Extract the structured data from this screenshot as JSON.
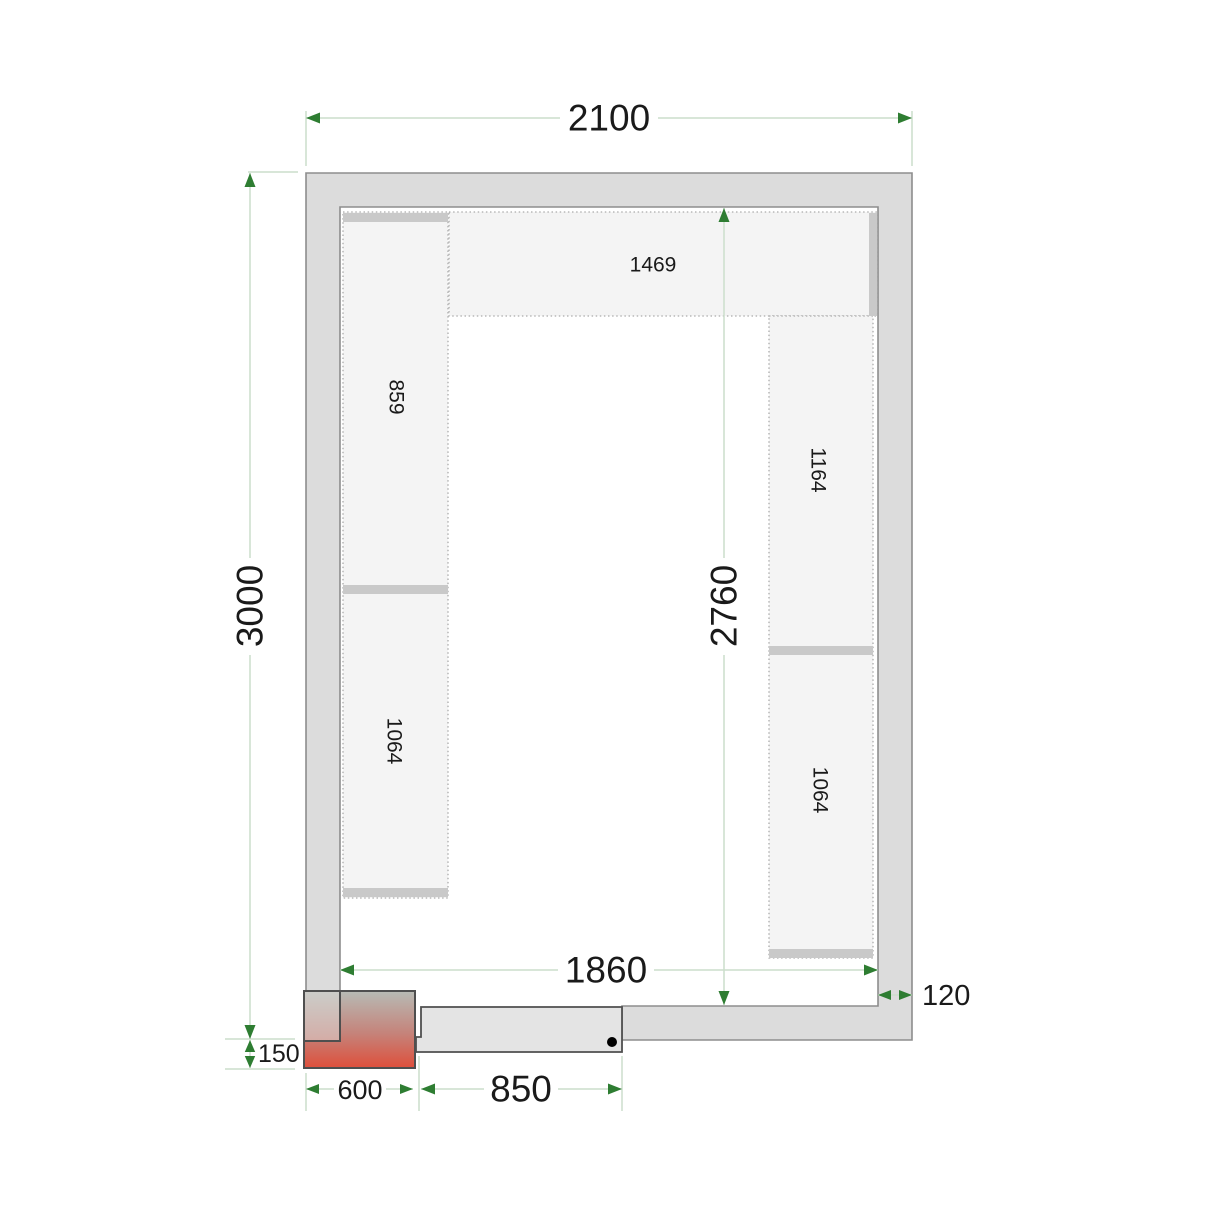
{
  "title": "Cold room floor plan with shelving",
  "dims": {
    "width_top": "2100",
    "height_left": "3000",
    "inner_height": "2760",
    "inner_width": "1860",
    "wall_thickness": "120",
    "unit_offset": "150",
    "unit_width": "600",
    "door_opening": "850"
  },
  "shelves": {
    "top": "1469",
    "left_upper": "859",
    "left_lower": "1064",
    "right_upper": "1164",
    "right_lower": "1064"
  },
  "colors": {
    "wall_fill": "#dcdcdc",
    "wall_stroke": "#8d8d8d",
    "shelf_fill": "#f4f4f4",
    "shelf_stroke": "#ababab",
    "bar_fill": "#c9c9c9",
    "door_fill": "#e4e4e4",
    "outline_dark": "#4f4f4f",
    "dim_line": "#ccdecc",
    "arrow_green": "#2e7d32",
    "unit_top": "#b7bbb5",
    "unit_mid": "#c5837a",
    "unit_bottom": "#de4f3b",
    "label_text": "#1a1a1a"
  }
}
